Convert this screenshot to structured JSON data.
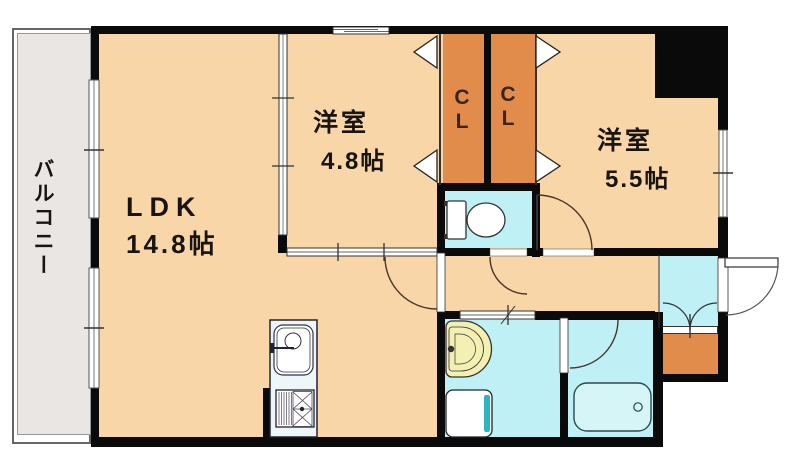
{
  "plan_title": "1LDK+2 apartment floor plan",
  "rooms": {
    "balcony": {
      "label": "バルコニー"
    },
    "ldk": {
      "name": "LDK",
      "size": "14.8帖"
    },
    "bedroom_west": {
      "name": "洋室",
      "size": "4.8帖"
    },
    "bedroom_east": {
      "name": "洋室",
      "size": "5.5帖"
    },
    "closet_west": {
      "letters": [
        "C",
        "L"
      ]
    },
    "closet_east": {
      "letters": [
        "C",
        "L"
      ]
    }
  },
  "fixtures": [
    "toilet",
    "kitchen-sink",
    "gas-stove",
    "washbasin",
    "washing-machine-pan",
    "bathtub",
    "entrance-double-closet",
    "front-door",
    "bifold-closet-doors",
    "sliding-windows"
  ],
  "colors": {
    "room_floor": "#F8D6A8",
    "wet_area_floor": "#BEF0F5",
    "closet": "#E28C4B",
    "wall": "#0A0A0A",
    "balcony_deck": "#E9E6E3",
    "washbasin": "#F4EFB2",
    "bathtub": "#D6F5F7",
    "washer_accent": "#2CB6C4",
    "counter": "#EDF7F9"
  }
}
